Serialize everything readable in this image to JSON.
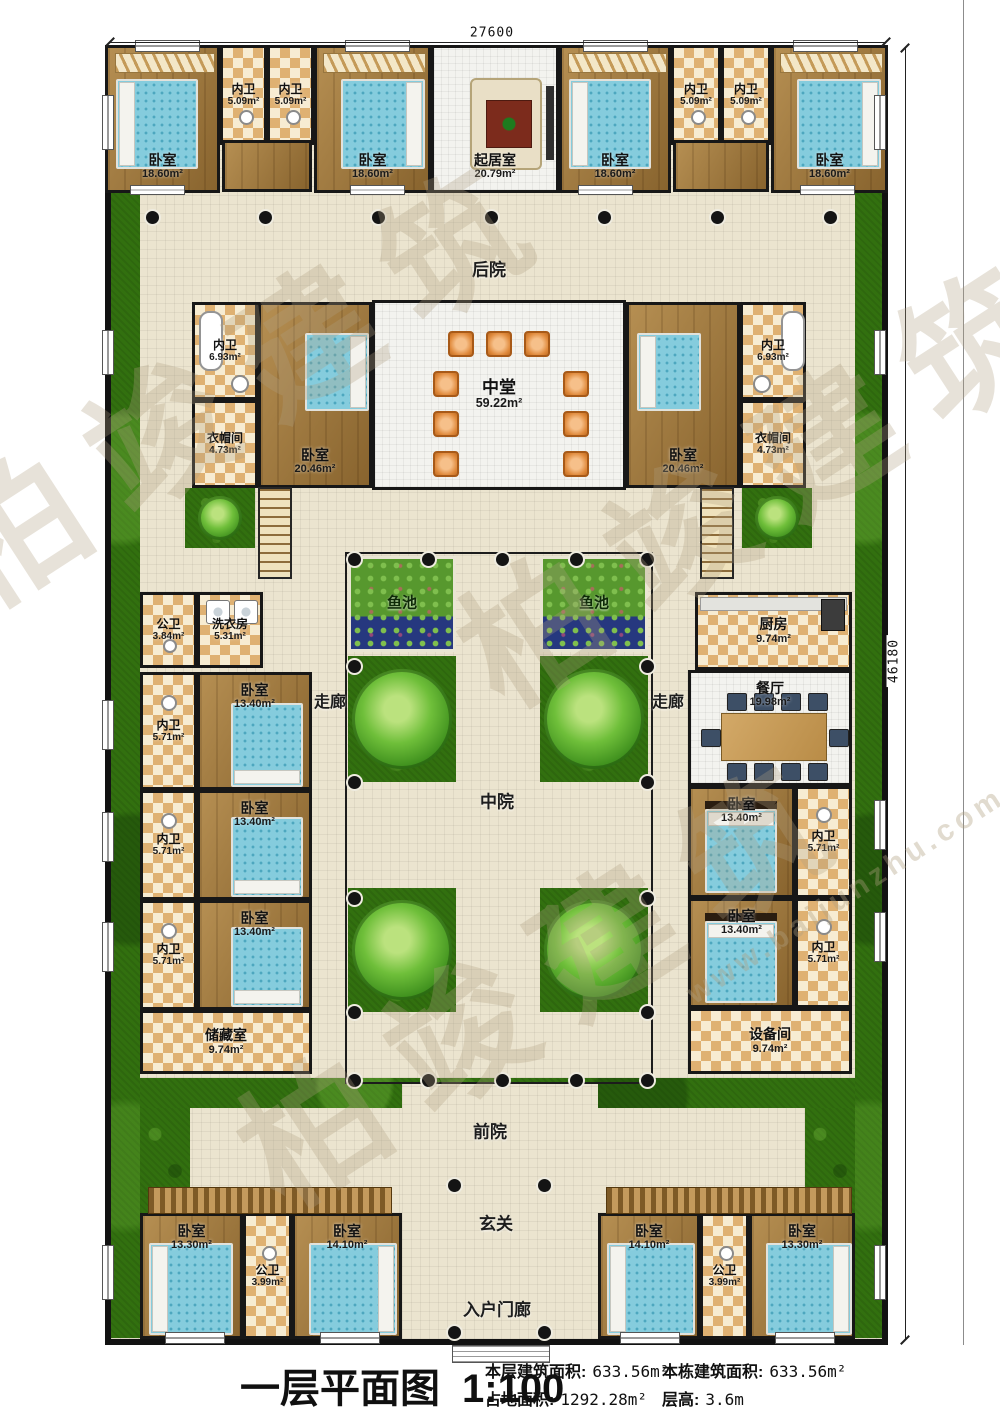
{
  "title_block": {
    "title": "一层平面图",
    "scale": "1:100",
    "stats": [
      {
        "label": "本层建筑面积:",
        "value": "633.56m²"
      },
      {
        "label": "本栋建筑面积:",
        "value": "633.56m²"
      },
      {
        "label": "占地面积:",
        "value": "1292.28m²"
      },
      {
        "label": "层高:",
        "value": "3.6m"
      }
    ]
  },
  "dimensions": {
    "top": "27600",
    "right": "46180"
  },
  "watermark": {
    "brand": "柏竣建筑",
    "site": "www.baijunzhu.com"
  },
  "zones": {
    "backyard": "后院",
    "midyard": "中院",
    "frontyard": "前院",
    "foyer": "玄关",
    "porch": "入户门廊",
    "corridor": "走廊",
    "pond": "鱼池"
  },
  "rooms": [
    {
      "name": "卧室",
      "area": "18.60m²"
    },
    {
      "name": "内卫",
      "area": "5.09m²"
    },
    {
      "name": "内卫",
      "area": "5.09m²"
    },
    {
      "name": "卧室",
      "area": "18.60m²"
    },
    {
      "name": "起居室",
      "area": "20.79m²"
    },
    {
      "name": "卧室",
      "area": "18.60m²"
    },
    {
      "name": "内卫",
      "area": "5.09m²"
    },
    {
      "name": "内卫",
      "area": "5.09m²"
    },
    {
      "name": "卧室",
      "area": "18.60m²"
    },
    {
      "name": "内卫",
      "area": "6.93m²"
    },
    {
      "name": "衣帽间",
      "area": "4.73m²"
    },
    {
      "name": "卧室",
      "area": "20.46m²"
    },
    {
      "name": "中堂",
      "area": "59.22m²"
    },
    {
      "name": "卧室",
      "area": "20.46m²"
    },
    {
      "name": "内卫",
      "area": "6.93m²"
    },
    {
      "name": "衣帽间",
      "area": "4.73m²"
    },
    {
      "name": "公卫",
      "area": "3.84m²"
    },
    {
      "name": "洗衣房",
      "area": "5.31m²"
    },
    {
      "name": "卧室",
      "area": "13.40m²"
    },
    {
      "name": "内卫",
      "area": "5.71m²"
    },
    {
      "name": "卧室",
      "area": "13.40m²"
    },
    {
      "name": "内卫",
      "area": "5.71m²"
    },
    {
      "name": "卧室",
      "area": "13.40m²"
    },
    {
      "name": "内卫",
      "area": "5.71m²"
    },
    {
      "name": "储藏室",
      "area": "9.74m²"
    },
    {
      "name": "厨房",
      "area": "9.74m²"
    },
    {
      "name": "餐厅",
      "area": "19.98m²"
    },
    {
      "name": "卧室",
      "area": "13.40m²"
    },
    {
      "name": "内卫",
      "area": "5.71m²"
    },
    {
      "name": "卧室",
      "area": "13.40m²"
    },
    {
      "name": "内卫",
      "area": "5.71m²"
    },
    {
      "name": "设备间",
      "area": "9.74m²"
    },
    {
      "name": "卧室",
      "area": "13.30m²"
    },
    {
      "name": "公卫",
      "area": "3.99m²"
    },
    {
      "name": "卧室",
      "area": "14.10m²"
    },
    {
      "name": "卧室",
      "area": "14.10m²"
    },
    {
      "name": "公卫",
      "area": "3.99m²"
    },
    {
      "name": "卧室",
      "area": "13.30m²"
    }
  ]
}
